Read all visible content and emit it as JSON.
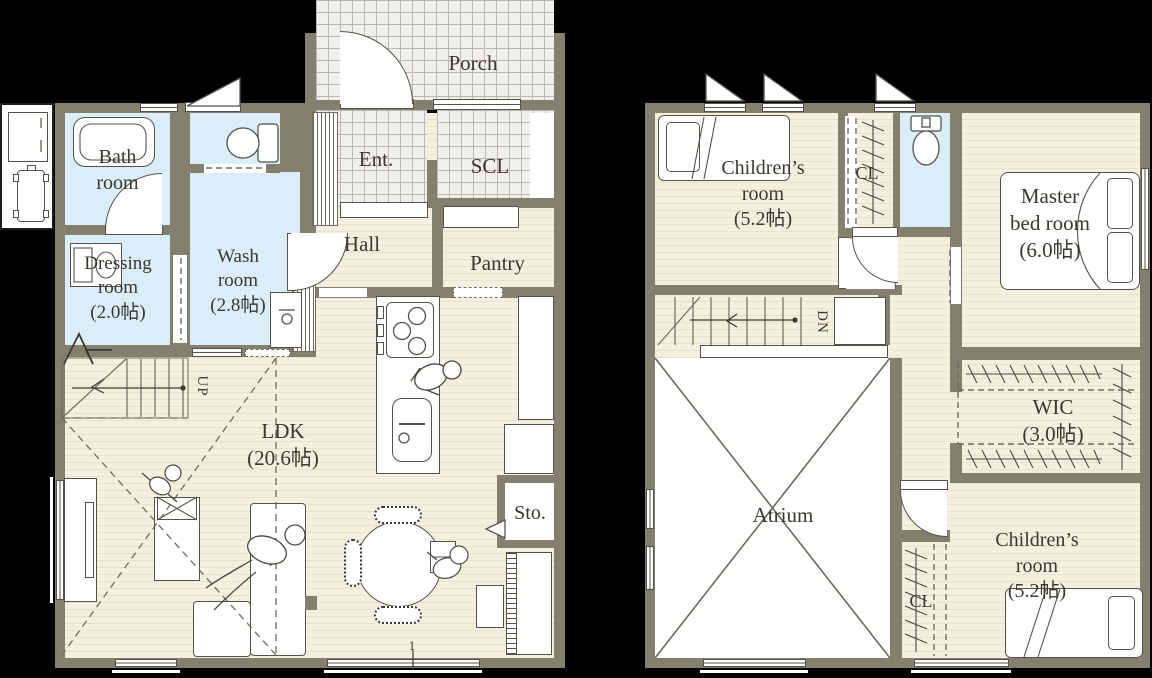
{
  "colors": {
    "background": "#000000",
    "wall": "#83806f",
    "floor": "#f4f0df",
    "floor_stripe": "#e7e3cc",
    "wet": "#daedf8",
    "tile_bg": "#f1f0ec",
    "tile_line": "#b9b7af",
    "outline": "#55524a",
    "line2": "#6f6c5f",
    "text": "#3b382f"
  },
  "floor1": {
    "rooms": {
      "porch": "Porch",
      "ent": "Ent.",
      "scl": "SCL",
      "hall": "Hall",
      "pantry": "Pantry",
      "bath": "Bath\nroom",
      "dressing": "Dressing\nroom\n(2.0帖)",
      "wash": "Wash\nroom\n(2.8帖)",
      "ldk": "LDK\n(20.6帖)",
      "sto": "Sto."
    },
    "stairs_label": "UP",
    "bottom_marker": "1"
  },
  "floor2": {
    "rooms": {
      "children_room_north": "Children’s\nroom\n(5.2帖)",
      "closet_north": "CL",
      "master": "Master\nbed room\n(6.0帖)",
      "wic": "WIC\n(3.0帖)",
      "atrium": "Atrium",
      "children_room_south": "Children’s\nroom\n(5.2帖)",
      "closet_south": "CL"
    },
    "stairs_label": "DN"
  }
}
